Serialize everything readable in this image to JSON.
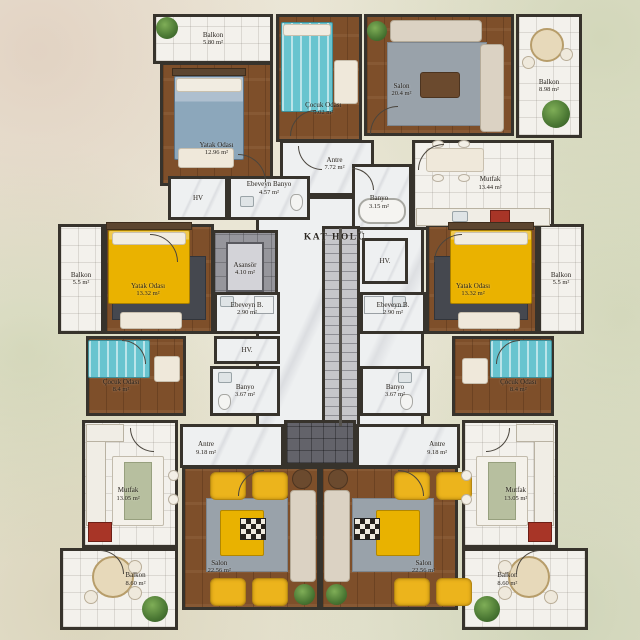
{
  "title": "KAT HOLÜ",
  "colors": {
    "wall": "#37332c",
    "wood": "#7e4f2a",
    "tile": "#f3f1ec",
    "marble": "#eef0f1",
    "accent_yellow": "#eab200",
    "teal": "#68c4cf",
    "blue_bed": "#8ca7bb",
    "sofa_beige": "#dbd2c3",
    "rug_gray": "#99a2aa",
    "plant_green": "#4a7733",
    "stair_gray": "#c6c6ca",
    "background": "#e9e5d4"
  },
  "rooms": [
    {
      "id": "kat-holu",
      "name": "KAT HOLÜ",
      "area": "",
      "x": 256,
      "y": 196,
      "w": 168,
      "h": 232,
      "floor": "marble",
      "ll": 47,
      "lt": 18,
      "hall": true
    },
    {
      "id": "balkon-tl",
      "name": "Balkon",
      "area": "5.80 m²",
      "x": 153,
      "y": 14,
      "w": 120,
      "h": 50,
      "floor": "tile",
      "ll": 50,
      "lt": 50
    },
    {
      "id": "yatak-odasi-tl",
      "name": "Yatak Odası",
      "area": "12.96 m²",
      "x": 160,
      "y": 62,
      "w": 113,
      "h": 124,
      "floor": "wood",
      "ll": 50,
      "lt": 70
    },
    {
      "id": "cocuk-odasi-tc",
      "name": "Çocuk Odası",
      "area": "9.02 m²",
      "x": 276,
      "y": 14,
      "w": 86,
      "h": 128,
      "floor": "wood",
      "ll": 55,
      "lt": 74
    },
    {
      "id": "salon-tr",
      "name": "Salon",
      "area": "20.4 m²",
      "x": 364,
      "y": 14,
      "w": 150,
      "h": 122,
      "floor": "wood",
      "ll": 25,
      "lt": 62
    },
    {
      "id": "balkon-tr",
      "name": "Balkon",
      "area": "8.98 m²",
      "x": 516,
      "y": 14,
      "w": 66,
      "h": 124,
      "floor": "tile",
      "ll": 50,
      "lt": 58
    },
    {
      "id": "antre-t",
      "name": "Antre",
      "area": "7.72 m²",
      "x": 280,
      "y": 140,
      "w": 94,
      "h": 56,
      "floor": "marble",
      "ll": 58,
      "lt": 42
    },
    {
      "id": "mutfak-tr",
      "name": "Mutfak",
      "area": "13.44 m²",
      "x": 412,
      "y": 140,
      "w": 142,
      "h": 90,
      "floor": "tile",
      "ll": 55,
      "lt": 48
    },
    {
      "id": "banyo-t",
      "name": "Banyo",
      "area": "3.15 m²",
      "x": 352,
      "y": 164,
      "w": 60,
      "h": 66,
      "floor": "marble",
      "ll": 45,
      "lt": 58
    },
    {
      "id": "ebeveyn-banyo-t",
      "name": "Ebeveyn Banyo",
      "area": "4.57 m²",
      "x": 228,
      "y": 176,
      "w": 82,
      "h": 44,
      "floor": "marble",
      "ll": 50,
      "lt": 28
    },
    {
      "id": "hv-tl",
      "name": "HV",
      "area": "",
      "x": 168,
      "y": 176,
      "w": 60,
      "h": 44,
      "floor": "marble",
      "ll": 50,
      "lt": 50
    },
    {
      "id": "balkon-ml",
      "name": "Balkon",
      "area": "5.5 m²",
      "x": 58,
      "y": 224,
      "w": 46,
      "h": 110,
      "floor": "tile",
      "ll": 50,
      "lt": 50
    },
    {
      "id": "yatak-odasi-ml",
      "name": "Yatak Odası",
      "area": "13.32 m²",
      "x": 104,
      "y": 224,
      "w": 110,
      "h": 110,
      "floor": "wood",
      "ll": 40,
      "lt": 60
    },
    {
      "id": "cocuk-odasi-ml",
      "name": "Çocuk Odası",
      "area": "8.4 m²",
      "x": 86,
      "y": 336,
      "w": 100,
      "h": 80,
      "floor": "wood",
      "ll": 35,
      "lt": 62
    },
    {
      "id": "yatak-odasi-mr",
      "name": "Yatak Odası",
      "area": "13.32 m²",
      "x": 426,
      "y": 224,
      "w": 112,
      "h": 110,
      "floor": "wood",
      "ll": 42,
      "lt": 60
    },
    {
      "id": "balkon-mr",
      "name": "Balkon",
      "area": "5.5 m²",
      "x": 538,
      "y": 224,
      "w": 46,
      "h": 110,
      "floor": "tile",
      "ll": 50,
      "lt": 50
    },
    {
      "id": "cocuk-odasi-mr",
      "name": "Çocuk Odası",
      "area": "8.4 m²",
      "x": 452,
      "y": 336,
      "w": 102,
      "h": 80,
      "floor": "wood",
      "ll": 65,
      "lt": 62
    },
    {
      "id": "asansor",
      "name": "Asansör",
      "area": "4.10 m²",
      "x": 212,
      "y": 230,
      "w": 66,
      "h": 78,
      "floor": "graytile",
      "ll": 50,
      "lt": 50
    },
    {
      "id": "stairs",
      "name": "",
      "area": "",
      "x": 322,
      "y": 226,
      "w": 38,
      "h": 202,
      "floor": "stairs",
      "ll": 50,
      "lt": 50
    },
    {
      "id": "hv-c",
      "name": "HV.",
      "area": "",
      "x": 362,
      "y": 238,
      "w": 46,
      "h": 46,
      "floor": "marble",
      "ll": 50,
      "lt": 50
    },
    {
      "id": "ebeveyn-b-l",
      "name": "Ebeveyn B.",
      "area": "2.90 m²",
      "x": 214,
      "y": 292,
      "w": 66,
      "h": 42,
      "floor": "marble",
      "ll": 50,
      "lt": 40
    },
    {
      "id": "ebeveyn-b-r",
      "name": "Ebeveyn B.",
      "area": "2.90 m²",
      "x": 360,
      "y": 292,
      "w": 66,
      "h": 42,
      "floor": "marble",
      "ll": 50,
      "lt": 40
    },
    {
      "id": "hv-l",
      "name": "HV.",
      "area": "",
      "x": 214,
      "y": 336,
      "w": 66,
      "h": 28,
      "floor": "marble",
      "ll": 50,
      "lt": 50
    },
    {
      "id": "banyo-l",
      "name": "Banyo",
      "area": "3.67 m²",
      "x": 210,
      "y": 366,
      "w": 70,
      "h": 50,
      "floor": "marble",
      "ll": 50,
      "lt": 50
    },
    {
      "id": "banyo-r",
      "name": "Banyo",
      "area": "3.67 m²",
      "x": 360,
      "y": 366,
      "w": 70,
      "h": 50,
      "floor": "marble",
      "ll": 50,
      "lt": 50
    },
    {
      "id": "antre-bl",
      "name": "Antre",
      "area": "9.18 m²",
      "x": 180,
      "y": 424,
      "w": 104,
      "h": 44,
      "floor": "marble",
      "ll": 25,
      "lt": 55
    },
    {
      "id": "antre-br",
      "name": "Antre",
      "area": "9.18 m²",
      "x": 356,
      "y": 424,
      "w": 104,
      "h": 44,
      "floor": "marble",
      "ll": 78,
      "lt": 55
    },
    {
      "id": "light-well",
      "name": "",
      "area": "",
      "x": 284,
      "y": 420,
      "w": 72,
      "h": 46,
      "floor": "dark",
      "ll": 50,
      "lt": 50
    },
    {
      "id": "salon-bl",
      "name": "Salon",
      "area": "22.56 m²",
      "x": 182,
      "y": 466,
      "w": 138,
      "h": 144,
      "floor": "wood",
      "ll": 27,
      "lt": 70
    },
    {
      "id": "salon-br",
      "name": "Salon",
      "area": "22.56 m²",
      "x": 320,
      "y": 466,
      "w": 138,
      "h": 144,
      "floor": "wood",
      "ll": 75,
      "lt": 70
    },
    {
      "id": "mutfak-bl",
      "name": "Mutfak",
      "area": "13.05 m²",
      "x": 82,
      "y": 420,
      "w": 96,
      "h": 128,
      "floor": "tile",
      "ll": 48,
      "lt": 58
    },
    {
      "id": "mutfak-br",
      "name": "Mutfak",
      "area": "13.05 m²",
      "x": 462,
      "y": 420,
      "w": 96,
      "h": 128,
      "floor": "tile",
      "ll": 56,
      "lt": 58
    },
    {
      "id": "balkon-bl",
      "name": "Balkon",
      "area": "8.60 m²",
      "x": 60,
      "y": 548,
      "w": 118,
      "h": 82,
      "floor": "tile",
      "ll": 64,
      "lt": 38
    },
    {
      "id": "balkon-br",
      "name": "Balkon",
      "area": "8.60 m²",
      "x": 462,
      "y": 548,
      "w": 126,
      "h": 82,
      "floor": "tile",
      "ll": 36,
      "lt": 38
    }
  ],
  "furniture": [
    {
      "cls": "plant",
      "x": 156,
      "y": 17,
      "w": 22,
      "h": 22
    },
    {
      "cls": "headboard",
      "x": 172,
      "y": 68,
      "w": 74,
      "h": 8
    },
    {
      "cls": "bedblue",
      "x": 174,
      "y": 76,
      "w": 70,
      "h": 84
    },
    {
      "cls": "pillow",
      "x": 176,
      "y": 78,
      "w": 66,
      "h": 14
    },
    {
      "cls": "table",
      "x": 178,
      "y": 148,
      "w": 56,
      "h": 20
    },
    {
      "cls": "bedteal",
      "x": 281,
      "y": 22,
      "w": 52,
      "h": 90
    },
    {
      "cls": "pillow",
      "x": 283,
      "y": 24,
      "w": 48,
      "h": 12
    },
    {
      "cls": "table",
      "x": 334,
      "y": 60,
      "w": 24,
      "h": 44
    },
    {
      "cls": "rug",
      "x": 387,
      "y": 42,
      "w": 100,
      "h": 84
    },
    {
      "cls": "sofa",
      "x": 390,
      "y": 20,
      "w": 92,
      "h": 22
    },
    {
      "cls": "sofa",
      "x": 480,
      "y": 44,
      "w": 24,
      "h": 88
    },
    {
      "cls": "tabled",
      "x": 420,
      "y": 72,
      "w": 40,
      "h": 26
    },
    {
      "cls": "plant",
      "x": 367,
      "y": 21,
      "w": 20,
      "h": 20
    },
    {
      "cls": "round",
      "x": 530,
      "y": 28,
      "w": 34,
      "h": 34
    },
    {
      "cls": "roundsm",
      "x": 522,
      "y": 56,
      "w": 13,
      "h": 13
    },
    {
      "cls": "roundsm",
      "x": 560,
      "y": 48,
      "w": 13,
      "h": 13
    },
    {
      "cls": "plant",
      "x": 542,
      "y": 100,
      "w": 28,
      "h": 28
    },
    {
      "cls": "table",
      "x": 426,
      "y": 148,
      "w": 58,
      "h": 24
    },
    {
      "cls": "stool",
      "x": 432,
      "y": 140,
      "w": 12,
      "h": 8
    },
    {
      "cls": "stool",
      "x": 458,
      "y": 140,
      "w": 12,
      "h": 8
    },
    {
      "cls": "stool",
      "x": 432,
      "y": 174,
      "w": 12,
      "h": 8
    },
    {
      "cls": "stool",
      "x": 458,
      "y": 174,
      "w": 12,
      "h": 8
    },
    {
      "cls": "counter",
      "x": 416,
      "y": 208,
      "w": 134,
      "h": 18
    },
    {
      "cls": "stove",
      "x": 490,
      "y": 210,
      "w": 20,
      "h": 14
    },
    {
      "cls": "sink",
      "x": 452,
      "y": 211,
      "w": 16,
      "h": 11
    },
    {
      "cls": "tub",
      "x": 358,
      "y": 198,
      "w": 48,
      "h": 26
    },
    {
      "cls": "sink",
      "x": 240,
      "y": 196,
      "w": 14,
      "h": 11
    },
    {
      "cls": "toilet",
      "x": 290,
      "y": 194,
      "w": 13,
      "h": 17
    },
    {
      "cls": "elevcar",
      "x": 226,
      "y": 242,
      "w": 38,
      "h": 50
    },
    {
      "cls": "stairrail",
      "x": 339,
      "y": 228,
      "w": 3,
      "h": 198
    },
    {
      "cls": "rugdark",
      "x": 112,
      "y": 256,
      "w": 94,
      "h": 64
    },
    {
      "cls": "headboard",
      "x": 106,
      "y": 222,
      "w": 86,
      "h": 8
    },
    {
      "cls": "bedyellow",
      "x": 108,
      "y": 230,
      "w": 82,
      "h": 74
    },
    {
      "cls": "pillow",
      "x": 112,
      "y": 232,
      "w": 74,
      "h": 13
    },
    {
      "cls": "table",
      "x": 120,
      "y": 312,
      "w": 62,
      "h": 17
    },
    {
      "cls": "bedteal",
      "x": 88,
      "y": 340,
      "w": 62,
      "h": 38
    },
    {
      "cls": "table",
      "x": 154,
      "y": 356,
      "w": 26,
      "h": 26
    },
    {
      "cls": "sink",
      "x": 218,
      "y": 372,
      "w": 14,
      "h": 11
    },
    {
      "cls": "toilet",
      "x": 218,
      "y": 394,
      "w": 13,
      "h": 16
    },
    {
      "cls": "sink",
      "x": 398,
      "y": 372,
      "w": 14,
      "h": 11
    },
    {
      "cls": "toilet",
      "x": 400,
      "y": 394,
      "w": 13,
      "h": 16
    },
    {
      "cls": "sink",
      "x": 220,
      "y": 296,
      "w": 14,
      "h": 11
    },
    {
      "cls": "shower",
      "x": 254,
      "y": 296,
      "w": 20,
      "h": 18
    },
    {
      "cls": "sink",
      "x": 392,
      "y": 296,
      "w": 14,
      "h": 11
    },
    {
      "cls": "shower",
      "x": 364,
      "y": 296,
      "w": 20,
      "h": 18
    },
    {
      "cls": "rugdark",
      "x": 434,
      "y": 256,
      "w": 94,
      "h": 64
    },
    {
      "cls": "headboard",
      "x": 448,
      "y": 222,
      "w": 86,
      "h": 8
    },
    {
      "cls": "bedyellow",
      "x": 450,
      "y": 230,
      "w": 82,
      "h": 74
    },
    {
      "cls": "pillow",
      "x": 454,
      "y": 232,
      "w": 74,
      "h": 13
    },
    {
      "cls": "table",
      "x": 458,
      "y": 312,
      "w": 62,
      "h": 17
    },
    {
      "cls": "bedteal",
      "x": 490,
      "y": 340,
      "w": 62,
      "h": 38
    },
    {
      "cls": "table",
      "x": 462,
      "y": 358,
      "w": 26,
      "h": 26
    },
    {
      "cls": "rug",
      "x": 206,
      "y": 498,
      "w": 82,
      "h": 74
    },
    {
      "cls": "blanket",
      "x": 220,
      "y": 510,
      "w": 44,
      "h": 46
    },
    {
      "cls": "checker",
      "x": 240,
      "y": 518,
      "w": 26,
      "h": 22
    },
    {
      "cls": "chairy",
      "x": 210,
      "y": 472,
      "w": 36,
      "h": 28
    },
    {
      "cls": "chairy",
      "x": 252,
      "y": 472,
      "w": 36,
      "h": 28
    },
    {
      "cls": "chairy",
      "x": 210,
      "y": 578,
      "w": 36,
      "h": 28
    },
    {
      "cls": "chairy",
      "x": 252,
      "y": 578,
      "w": 36,
      "h": 28
    },
    {
      "cls": "sofa",
      "x": 290,
      "y": 490,
      "w": 26,
      "h": 92
    },
    {
      "cls": "rounddark",
      "x": 292,
      "y": 469,
      "w": 20,
      "h": 20
    },
    {
      "cls": "plant",
      "x": 294,
      "y": 584,
      "w": 21,
      "h": 21
    },
    {
      "cls": "rug",
      "x": 352,
      "y": 498,
      "w": 82,
      "h": 74
    },
    {
      "cls": "blanket",
      "x": 376,
      "y": 510,
      "w": 44,
      "h": 46
    },
    {
      "cls": "checker",
      "x": 354,
      "y": 518,
      "w": 26,
      "h": 22
    },
    {
      "cls": "chairy",
      "x": 394,
      "y": 472,
      "w": 36,
      "h": 28
    },
    {
      "cls": "chairy",
      "x": 436,
      "y": 472,
      "w": 36,
      "h": 28
    },
    {
      "cls": "chairy",
      "x": 394,
      "y": 578,
      "w": 36,
      "h": 28
    },
    {
      "cls": "chairy",
      "x": 436,
      "y": 578,
      "w": 36,
      "h": 28
    },
    {
      "cls": "sofa",
      "x": 324,
      "y": 490,
      "w": 26,
      "h": 92
    },
    {
      "cls": "rounddark",
      "x": 328,
      "y": 469,
      "w": 20,
      "h": 20
    },
    {
      "cls": "plant",
      "x": 326,
      "y": 584,
      "w": 21,
      "h": 21
    },
    {
      "cls": "counter",
      "x": 86,
      "y": 424,
      "w": 20,
      "h": 102
    },
    {
      "cls": "counter",
      "x": 86,
      "y": 424,
      "w": 38,
      "h": 18
    },
    {
      "cls": "island",
      "x": 112,
      "y": 456,
      "w": 52,
      "h": 70
    },
    {
      "cls": "runner",
      "x": 124,
      "y": 462,
      "w": 28,
      "h": 58
    },
    {
      "cls": "stool",
      "x": 168,
      "y": 470,
      "w": 11,
      "h": 11
    },
    {
      "cls": "stool",
      "x": 168,
      "y": 494,
      "w": 11,
      "h": 11
    },
    {
      "cls": "stove",
      "x": 88,
      "y": 522,
      "w": 24,
      "h": 20
    },
    {
      "cls": "counter",
      "x": 534,
      "y": 424,
      "w": 20,
      "h": 102
    },
    {
      "cls": "counter",
      "x": 516,
      "y": 424,
      "w": 38,
      "h": 18
    },
    {
      "cls": "island",
      "x": 476,
      "y": 456,
      "w": 52,
      "h": 70
    },
    {
      "cls": "runner",
      "x": 488,
      "y": 462,
      "w": 28,
      "h": 58
    },
    {
      "cls": "stool",
      "x": 461,
      "y": 470,
      "w": 11,
      "h": 11
    },
    {
      "cls": "stool",
      "x": 461,
      "y": 494,
      "w": 11,
      "h": 11
    },
    {
      "cls": "stove",
      "x": 528,
      "y": 522,
      "w": 24,
      "h": 20
    },
    {
      "cls": "round",
      "x": 92,
      "y": 556,
      "w": 42,
      "h": 42
    },
    {
      "cls": "roundsm",
      "x": 128,
      "y": 560,
      "w": 14,
      "h": 14
    },
    {
      "cls": "roundsm",
      "x": 128,
      "y": 586,
      "w": 14,
      "h": 14
    },
    {
      "cls": "roundsm",
      "x": 84,
      "y": 590,
      "w": 14,
      "h": 14
    },
    {
      "cls": "plant",
      "x": 142,
      "y": 596,
      "w": 26,
      "h": 26
    },
    {
      "cls": "round",
      "x": 508,
      "y": 556,
      "w": 42,
      "h": 42
    },
    {
      "cls": "roundsm",
      "x": 498,
      "y": 560,
      "w": 14,
      "h": 14
    },
    {
      "cls": "roundsm",
      "x": 498,
      "y": 586,
      "w": 14,
      "h": 14
    },
    {
      "cls": "roundsm",
      "x": 544,
      "y": 590,
      "w": 14,
      "h": 14
    },
    {
      "cls": "plant",
      "x": 474,
      "y": 596,
      "w": 26,
      "h": 26
    }
  ],
  "doors": [
    {
      "x": 298,
      "y": 146,
      "s": 24,
      "c": "bl"
    },
    {
      "x": 352,
      "y": 168,
      "s": 22,
      "c": "tr"
    },
    {
      "x": 238,
      "y": 154,
      "s": 28,
      "c": "tr"
    },
    {
      "x": 290,
      "y": 110,
      "s": 26,
      "c": "tl"
    },
    {
      "x": 370,
      "y": 106,
      "s": 28,
      "c": "tl"
    },
    {
      "x": 418,
      "y": 144,
      "s": 26,
      "c": "tl"
    },
    {
      "x": 150,
      "y": 234,
      "s": 28,
      "c": "tr"
    },
    {
      "x": 434,
      "y": 234,
      "s": 28,
      "c": "tl"
    },
    {
      "x": 122,
      "y": 340,
      "s": 24,
      "c": "tr"
    },
    {
      "x": 496,
      "y": 340,
      "s": 24,
      "c": "tl"
    },
    {
      "x": 238,
      "y": 470,
      "s": 26,
      "c": "tl"
    },
    {
      "x": 398,
      "y": 470,
      "s": 26,
      "c": "tr"
    },
    {
      "x": 130,
      "y": 428,
      "s": 24,
      "c": "bl"
    },
    {
      "x": 486,
      "y": 428,
      "s": 24,
      "c": "br"
    },
    {
      "x": 100,
      "y": 550,
      "s": 24,
      "c": "tr"
    },
    {
      "x": 516,
      "y": 550,
      "s": 24,
      "c": "tl"
    }
  ]
}
